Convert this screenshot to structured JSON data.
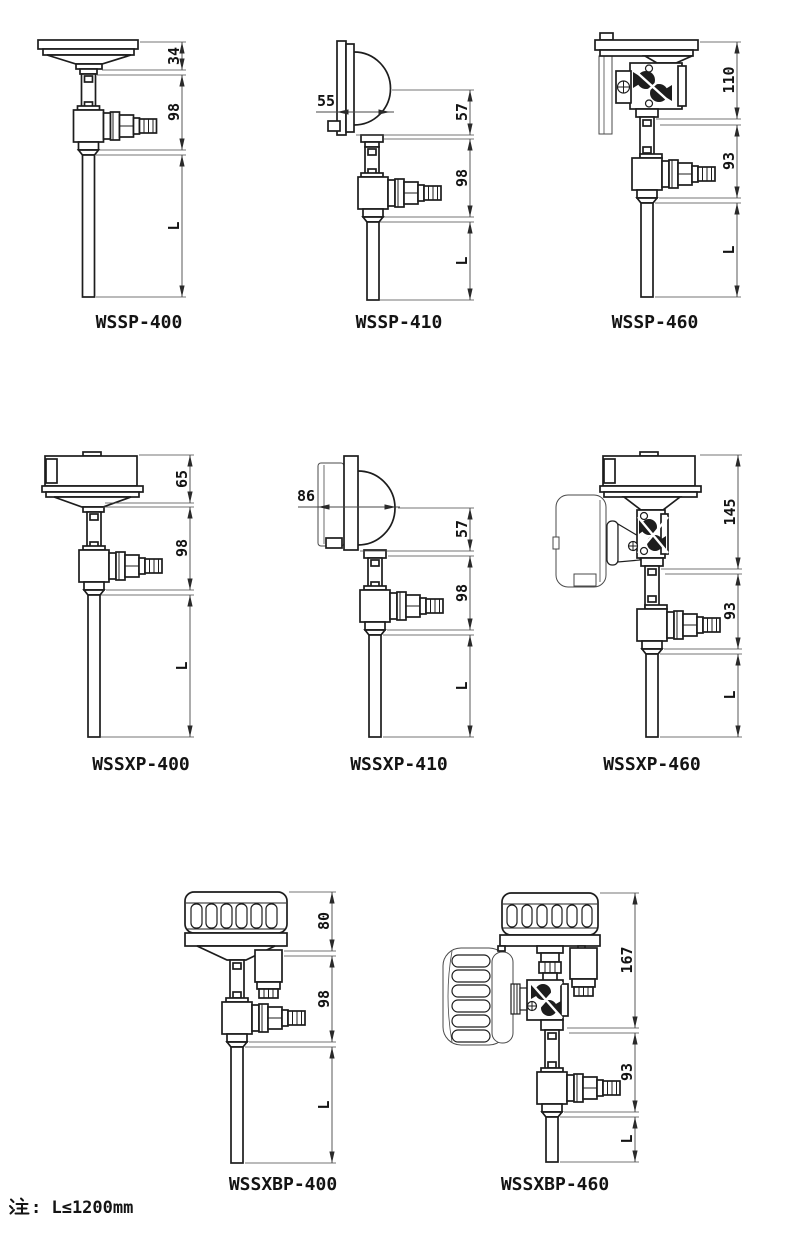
{
  "note": {
    "prefix": "注",
    "rest": ": L≤1200mm"
  },
  "figures": [
    {
      "label": "WSSP-400",
      "dims": [
        "34",
        "98",
        "L"
      ]
    },
    {
      "label": "WSSP-410",
      "dims": [
        "55",
        "57",
        "98",
        "L"
      ]
    },
    {
      "label": "WSSP-460",
      "dims": [
        "110",
        "93",
        "L"
      ]
    },
    {
      "label": "WSSXP-400",
      "dims": [
        "65",
        "98",
        "L"
      ]
    },
    {
      "label": "WSSXP-410",
      "dims": [
        "86",
        "57",
        "98",
        "L"
      ]
    },
    {
      "label": "WSSXP-460",
      "dims": [
        "145",
        "93",
        "L"
      ]
    },
    {
      "label": "WSSXBP-400",
      "dims": [
        "80",
        "98",
        "L"
      ]
    },
    {
      "label": "WSSXBP-460",
      "dims": [
        "167",
        "93",
        "L"
      ]
    }
  ],
  "colors": {
    "line": "#1d1d1d",
    "background": "#ffffff"
  }
}
